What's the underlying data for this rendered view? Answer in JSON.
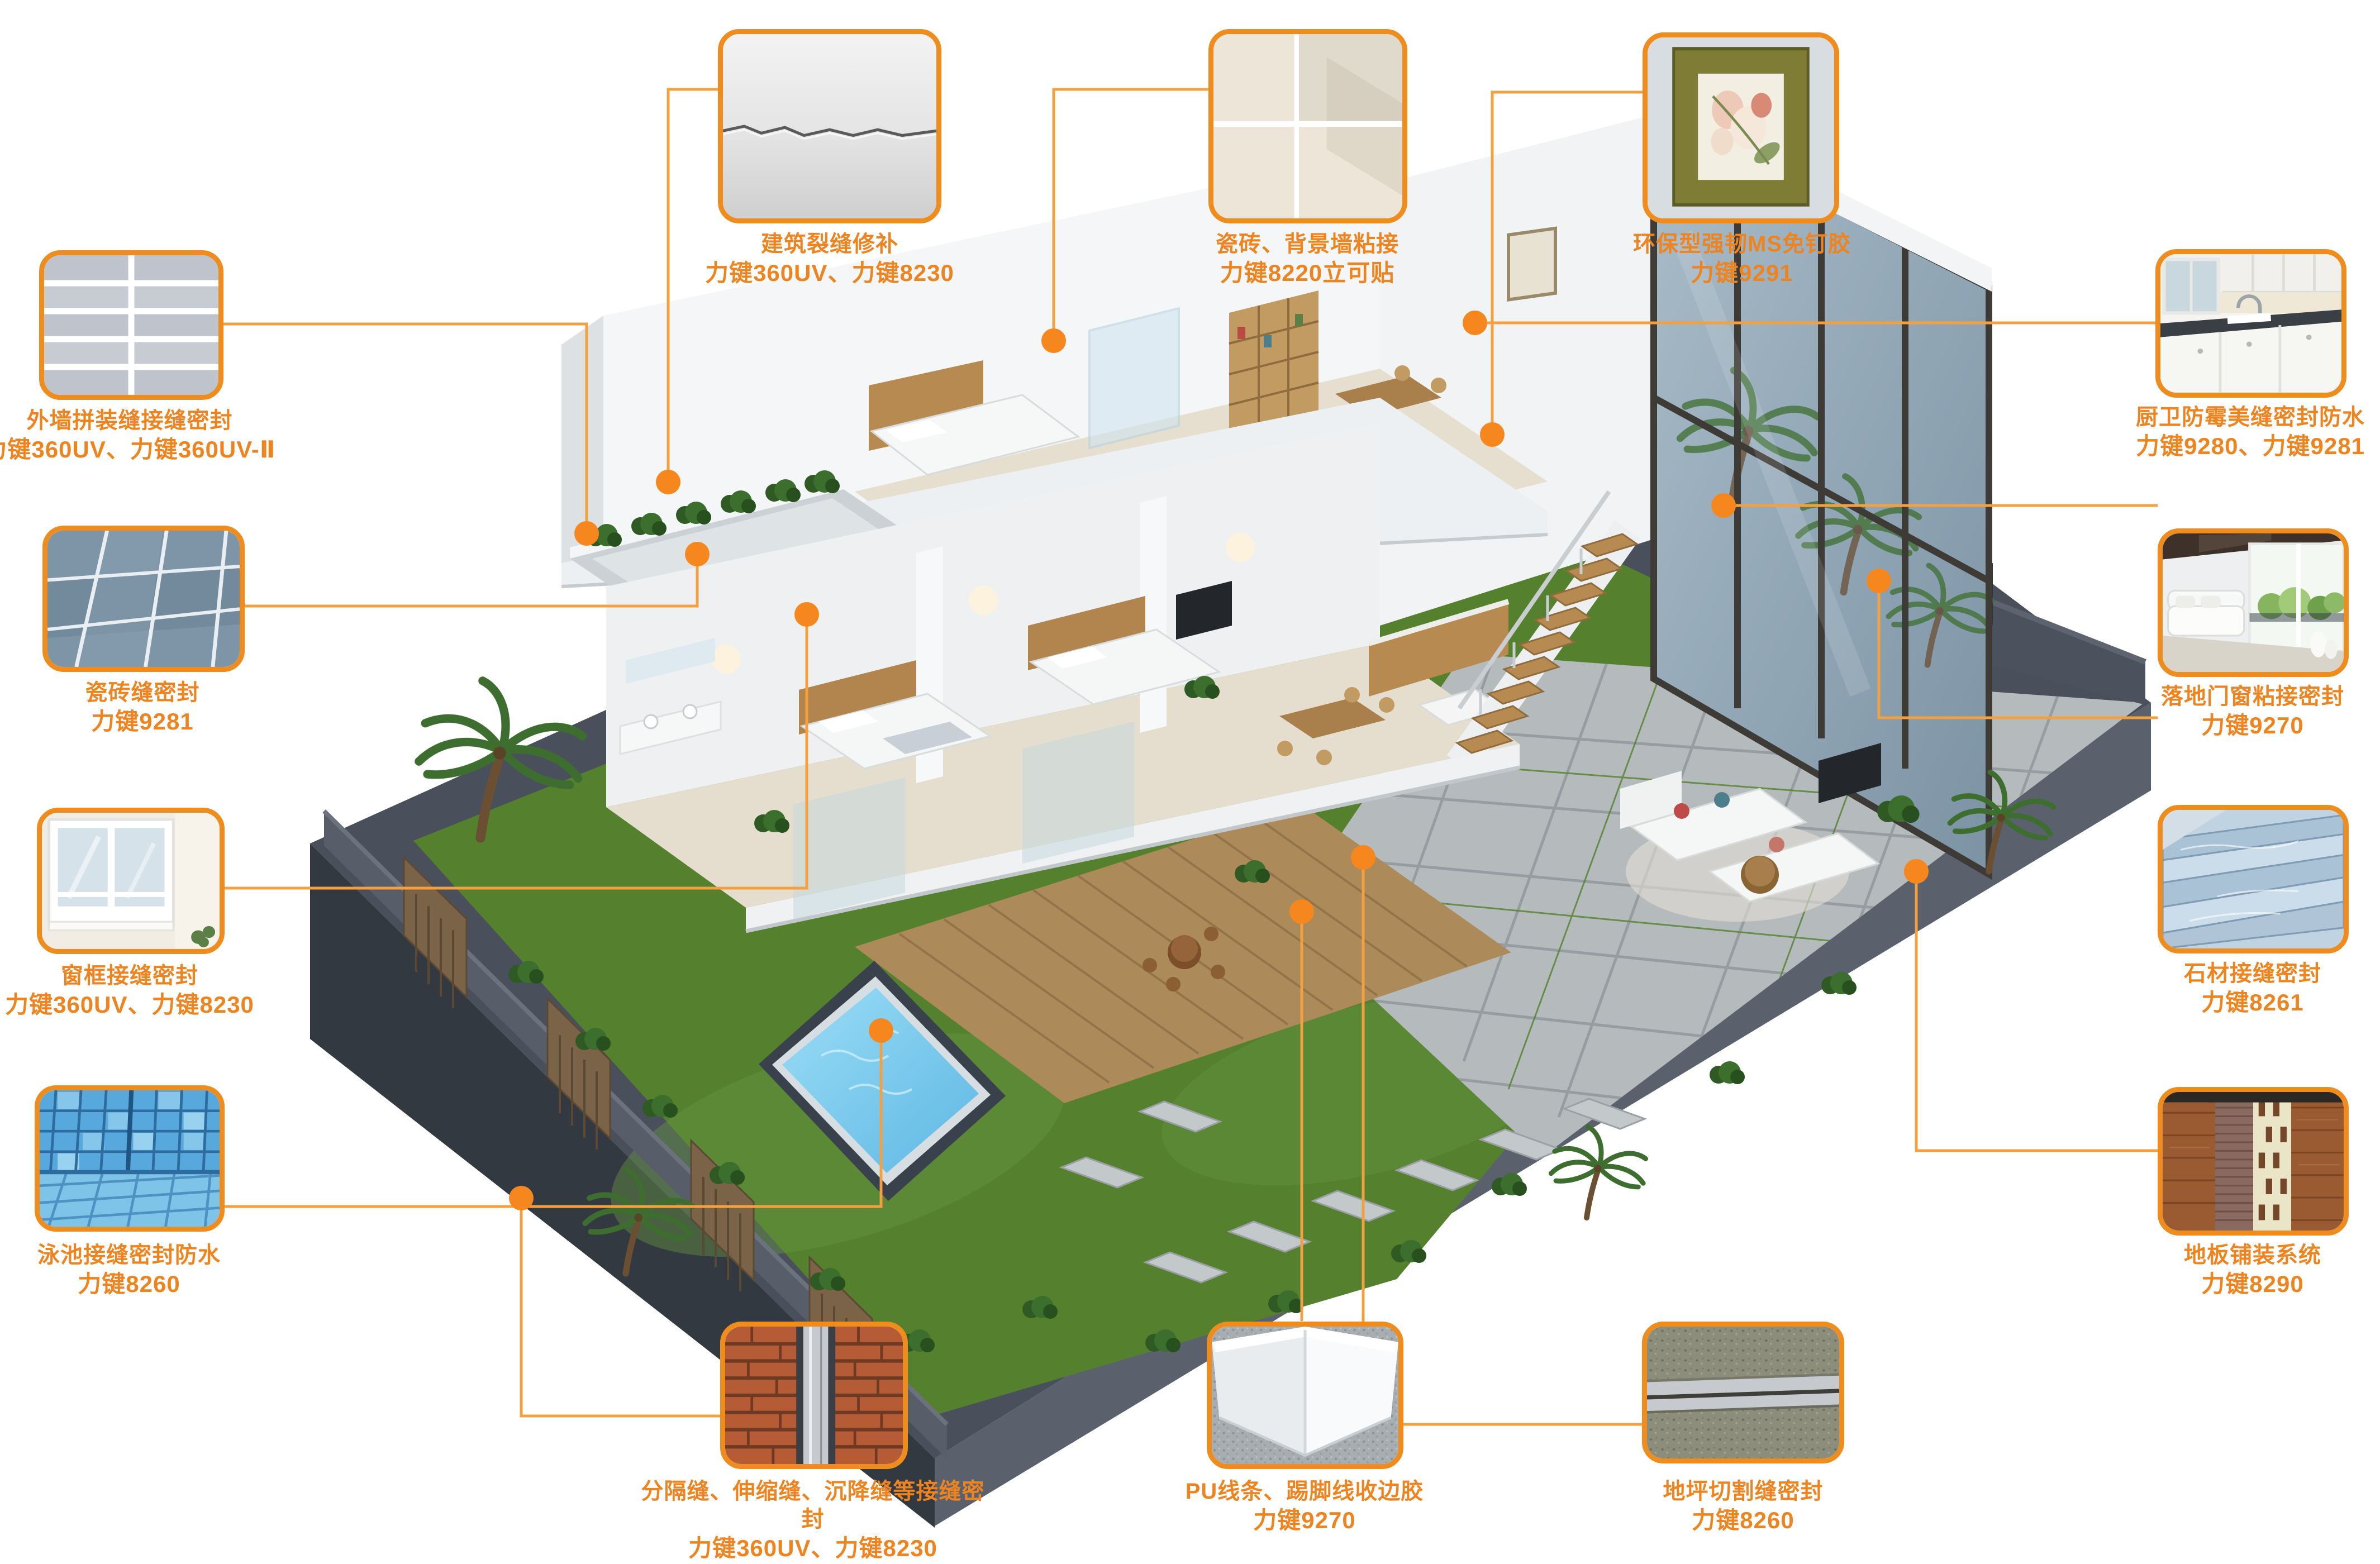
{
  "colors": {
    "accent_border": "#EE8C1E",
    "accent_text": "#EE8420",
    "leader_line": "#F3A140",
    "anchor_dot": "#F6871E",
    "platform": "#49505B",
    "lawn": "#55812E",
    "pool_water": "#7CCDEF"
  },
  "callouts": {
    "top": [
      {
        "id": "crack-repair",
        "title": "建筑裂缝修补",
        "product": "力键360UV、力键8230"
      },
      {
        "id": "tile-wall-bonding",
        "title": "瓷砖、背景墙粘接",
        "product": "力键8220立可贴"
      },
      {
        "id": "ms-nail-free",
        "title": "环保型强韧MS免钉胶",
        "product": "力键9291"
      }
    ],
    "left": [
      {
        "id": "exterior-wall-seam",
        "title": "外墙拼装缝接缝密封",
        "product": "力键360UV、力键360UV-Ⅱ"
      },
      {
        "id": "tile-joint",
        "title": "瓷砖缝密封",
        "product": "力键9281"
      },
      {
        "id": "window-frame-seam",
        "title": "窗框接缝密封",
        "product": "力键360UV、力键8230"
      },
      {
        "id": "pool-joint",
        "title": "泳池接缝密封防水",
        "product": "力键8260"
      }
    ],
    "right": [
      {
        "id": "kitchen-bath-seal",
        "title": "厨卫防霉美缝密封防水",
        "product": "力键9280、力键9281"
      },
      {
        "id": "glass-door-bond",
        "title": "落地门窗粘接密封",
        "product": "力键9270"
      },
      {
        "id": "stone-joint",
        "title": "石材接缝密封",
        "product": "力键8261"
      },
      {
        "id": "floor-paving",
        "title": "地板铺装系统",
        "product": "力键8290"
      }
    ],
    "bottom": [
      {
        "id": "expansion-joint",
        "title": "分隔缝、伸缩缝、沉降缝等接缝密封",
        "product": "力键360UV、力键8230"
      },
      {
        "id": "pu-trim-glue",
        "title": "PU线条、踢脚线收边胶",
        "product": "力键9270"
      },
      {
        "id": "floor-cut-joint",
        "title": "地坪切割缝密封",
        "product": "力键8260"
      }
    ]
  }
}
